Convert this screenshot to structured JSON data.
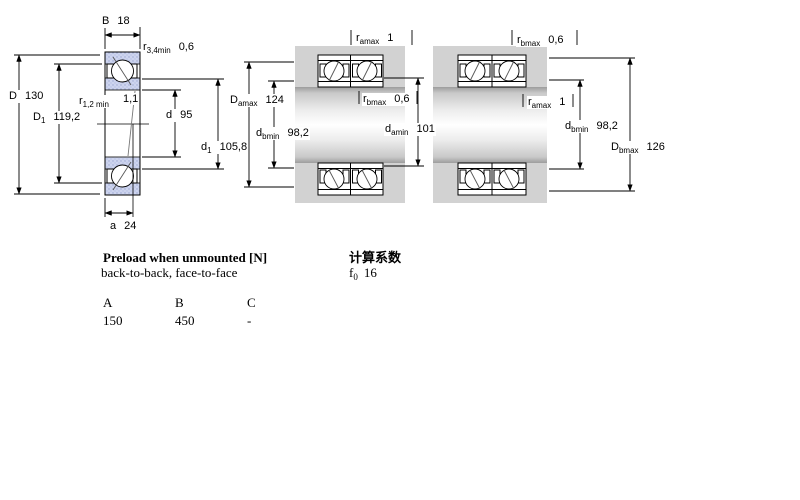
{
  "colors": {
    "ring_blue": "#cdd4ee",
    "ring_dot": "#9aa6d2",
    "housing_gray": "#d2d2d2",
    "line_black": "#000000"
  },
  "left_figure": {
    "B": {
      "sym": "B",
      "sub": "",
      "val": "18"
    },
    "r34": {
      "sym": "r",
      "sub": "3,4min",
      "val": "0,6"
    },
    "D": {
      "sym": "D",
      "sub": "",
      "val": "130"
    },
    "D1": {
      "sym": "D",
      "sub": "1",
      "val": "119,2"
    },
    "r12": {
      "sym": "r",
      "sub": "1,2 min",
      "val": "1,1"
    },
    "d": {
      "sym": "d",
      "sub": "",
      "val": "95"
    },
    "d1": {
      "sym": "d",
      "sub": "1",
      "val": "105,8"
    },
    "a": {
      "sym": "a",
      "sub": "",
      "val": "24"
    }
  },
  "middle_figure": {
    "ramax": {
      "sym": "r",
      "sub": "amax",
      "val": "1"
    },
    "Damax": {
      "sym": "D",
      "sub": "amax",
      "val": "124"
    },
    "rbmax": {
      "sym": "r",
      "sub": "bmax",
      "val": "0,6"
    },
    "dbmin": {
      "sym": "d",
      "sub": "bmin",
      "val": "98,2"
    },
    "damin": {
      "sym": "d",
      "sub": "amin",
      "val": "101"
    }
  },
  "right_figure": {
    "rbmax": {
      "sym": "r",
      "sub": "bmax",
      "val": "0,6"
    },
    "ramax": {
      "sym": "r",
      "sub": "amax",
      "val": "1"
    },
    "dbmin": {
      "sym": "d",
      "sub": "bmin",
      "val": "98,2"
    },
    "Dbmax": {
      "sym": "D",
      "sub": "bmax",
      "val": "126"
    }
  },
  "preload": {
    "title": "Preload when unmounted [N]",
    "subtitle": "back-to-back, face-to-face",
    "col_headers": [
      "A",
      "B",
      "C"
    ],
    "values": [
      "150",
      "450",
      "-"
    ]
  },
  "calc": {
    "title": "计算系数",
    "factor_sym": "f",
    "factor_sub": "0",
    "factor_val": "16"
  }
}
